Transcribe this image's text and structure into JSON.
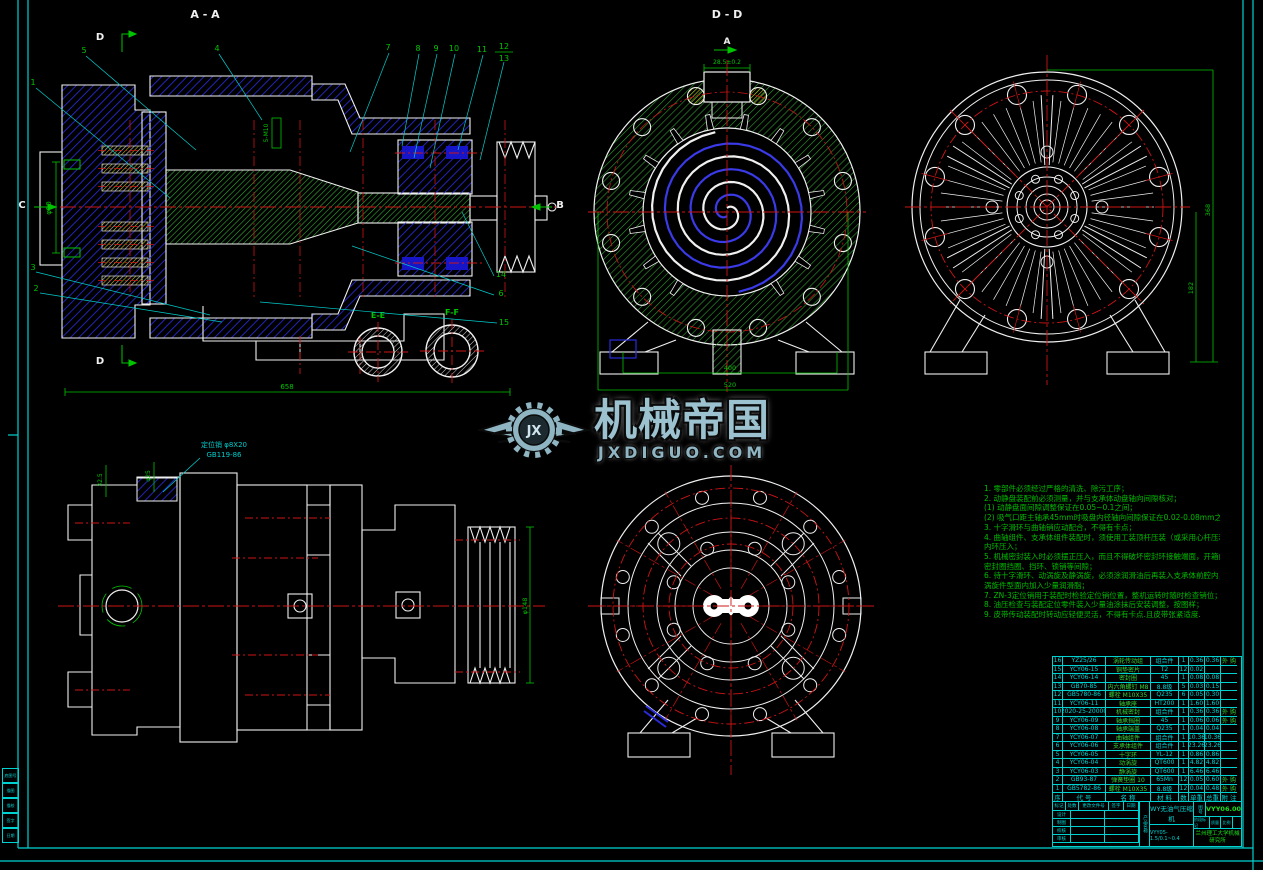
{
  "watermark": {
    "brand": "机械帝国",
    "domain": "JXDIGUO.COM",
    "monogram": "JX"
  },
  "views": {
    "aa": {
      "title": "A - A",
      "d_top": "D",
      "d_bottom": "D",
      "c": "C",
      "b": "B",
      "callouts_top": [
        "5",
        "4",
        "7",
        "8",
        "9",
        "10",
        "11",
        "12",
        "13"
      ],
      "callout_1": "1",
      "callout_3": "3",
      "callout_2": "2",
      "callout_14": "14",
      "callout_6": "6",
      "callout_15": "15",
      "detail_e": "E-E",
      "detail_f": "F-F",
      "dim_bottom": "658",
      "dim_left": "φ90",
      "dim_plug": "5-M10"
    },
    "dd": {
      "title": "D - D",
      "a": "A",
      "dim_top": "28.5±0.2",
      "dim_inner": "400",
      "dim_outer": "520"
    },
    "rear": {
      "dim_outer": "368",
      "dim_inner": "182"
    },
    "side": {
      "leader1": "定位销 φ8X20",
      "leader2": "GB119-86",
      "dim1": "32.5",
      "dim2": "φ25",
      "dim_pulley": "φ148"
    }
  },
  "notes": {
    "lines": [
      "1. 零部件必须经过严格的清洗、除污工序；",
      "2. 动静盘装配前必须测量，并与支承体动盘轴向间隙核对；",
      "(1) 动静盘面间隙调整保证在0.05~0.1之间；",
      "(2) 吸气口距主轴承45mm时吸盘内径轴向间隙保证在0.02-0.08mm之间；",
      "3. 十字滑环与曲轴销应动配合，不得有卡点；",
      "4. 曲轴组件、支承体组件装配时，须使用工装顶杆压装（或采用心杆压装）",
      "    内环压入；",
      "5. 机械密封装入时必须摆正压入，而且不得破坏密封环接触端面，开箱前清洗及",
      "    密封圈挡圈、挡环、锁销等间隙；",
      "6. 待十字滑环、动涡旋及静涡旋，必须涂润滑油后再装入支承体前腔内，",
      "    涡旋件型面内加入少量润滑脂；",
      "7. ZN-3定位销用于装配时检验定位销位置，整机运转时随时检查销位；",
      "8. 油压检查与装配定位零件装入少量油涂抹后安装调整，按图样；",
      "9. 皮带传动装配时转动应轻便灵活，不得有卡点.且皮带张紧适度."
    ]
  },
  "bom": {
    "headers": {
      "no": "序",
      "code": "代  号",
      "name": "名  称",
      "material": "材  料",
      "qty": "数",
      "unit": "单重",
      "total": "总重",
      "remark": "附 注"
    },
    "rows": [
      {
        "no": "16",
        "code": "YZ25/26",
        "name": "涡轮传动组",
        "material": "组合件",
        "qty": "1",
        "unit": "0.36",
        "total": "0.36",
        "remark": "外 购"
      },
      {
        "no": "15",
        "code": "YCY06-15",
        "name": "铜垫密片",
        "material": "T2",
        "qty": "12",
        "unit": "0.02",
        "total": "",
        "remark": ""
      },
      {
        "no": "14",
        "code": "YCY06-14",
        "name": "密封圈",
        "material": "45",
        "qty": "1",
        "unit": "0.08",
        "total": "0.08",
        "remark": ""
      },
      {
        "no": "13",
        "code": "GB70-85",
        "name": "内六角螺钉 M8",
        "material": "8.8级",
        "qty": "5",
        "unit": "0.03",
        "total": "0.15",
        "remark": ""
      },
      {
        "no": "12",
        "code": "GB5780-86",
        "name": "螺栓 M10X35",
        "material": "Q235",
        "qty": "6",
        "unit": "0.05",
        "total": "0.30",
        "remark": ""
      },
      {
        "no": "11",
        "code": "YCY06-11",
        "name": "轴承座",
        "material": "HT200",
        "qty": "1",
        "unit": "1.60",
        "total": "1.60",
        "remark": ""
      },
      {
        "no": "10",
        "code": "2020-25-20000",
        "name": "机械密封",
        "material": "组合件",
        "qty": "1",
        "unit": "0.36",
        "total": "0.36",
        "remark": "外 购"
      },
      {
        "no": "9",
        "code": "YCY06-09",
        "name": "轴承挡圈",
        "material": "45",
        "qty": "1",
        "unit": "0.06",
        "total": "0.06",
        "remark": "外 购"
      },
      {
        "no": "8",
        "code": "YCY06-08",
        "name": "轴承端盖",
        "material": "Q235",
        "qty": "1",
        "unit": "0.04",
        "total": "0.04",
        "remark": ""
      },
      {
        "no": "7",
        "code": "YCY06-07",
        "name": "曲轴组件",
        "material": "组合件",
        "qty": "1",
        "unit": "10.36",
        "total": "10.36",
        "remark": ""
      },
      {
        "no": "6",
        "code": "YCY06-06",
        "name": "支承体组件",
        "material": "组合件",
        "qty": "1",
        "unit": "23.26",
        "total": "23.26",
        "remark": ""
      },
      {
        "no": "5",
        "code": "YCY06-05",
        "name": "十字环",
        "material": "YL-12",
        "qty": "1",
        "unit": "0.86",
        "total": "0.86",
        "remark": ""
      },
      {
        "no": "4",
        "code": "YCY06-04",
        "name": "动涡旋",
        "material": "QT600",
        "qty": "1",
        "unit": "4.82",
        "total": "4.82",
        "remark": ""
      },
      {
        "no": "3",
        "code": "YCY06-03",
        "name": "静涡旋",
        "material": "QT600",
        "qty": "1",
        "unit": "6.46",
        "total": "6.46",
        "remark": ""
      },
      {
        "no": "2",
        "code": "GB93-87",
        "name": "弹簧垫圈 10",
        "material": "65Mn",
        "qty": "12",
        "unit": "0.05",
        "total": "0.60",
        "remark": "外 购"
      },
      {
        "no": "1",
        "code": "GB5782-86",
        "name": "螺栓 M10X35",
        "material": "8.8级",
        "qty": "12",
        "unit": "0.04",
        "total": "0.48",
        "remark": "外 购"
      }
    ]
  },
  "titleblock": {
    "product_label": "产品名称",
    "product_name": "WY无油气压缩机",
    "drawing_no_label": "图号",
    "drawing_no": "VYY06.00",
    "model": "VYY05-1.5/0.1~0.4",
    "org": "兰州理工大学机械研究所",
    "strip": [
      "标记",
      "处数",
      "更改文件号",
      "签字",
      "日期"
    ],
    "strip2": [
      "阶段标记",
      "质量",
      "比例"
    ],
    "sig_rows": [
      "设计",
      "制图",
      "校核",
      "审核"
    ]
  },
  "frame": {
    "edge_boxes": [
      "底图号",
      "描图",
      "描校",
      "签字",
      "日期"
    ]
  }
}
